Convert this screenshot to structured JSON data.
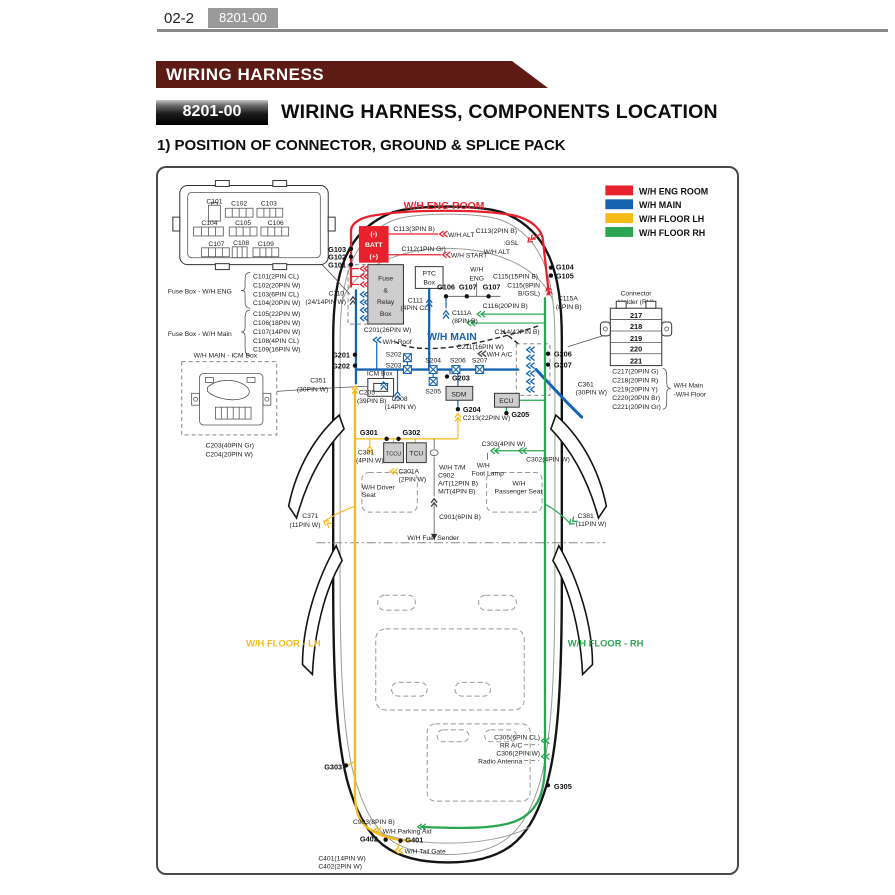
{
  "colors": {
    "eng": "#e8222d",
    "main": "#1663b1",
    "lh": "#f7bb17",
    "rh": "#2aa551",
    "banner": "#5e1a14",
    "badge": "#9a9a9a"
  },
  "header": {
    "page_number": "02-2",
    "code": "8201-00"
  },
  "banner": {
    "title": "WIRING HARNESS"
  },
  "section": {
    "code": "8201-00",
    "title": "WIRING HARNESS, COMPONENTS LOCATION",
    "subtitle": "1) POSITION OF CONNECTOR, GROUND & SPLICE PACK"
  },
  "legend": {
    "items": [
      {
        "label": "W/H ENG ROOM"
      },
      {
        "label": "W/H MAIN"
      },
      {
        "label": "W/H FLOOR LH"
      },
      {
        "label": "W/H FLOOR RH"
      }
    ]
  },
  "diagram": {
    "regions": {
      "eng": "W/H ENG ROOM",
      "main": "W/H MAIN",
      "lh": "W/H FLOOR - LH",
      "rh": "W/H FLOOR - RH"
    },
    "fusebox": {
      "conns": [
        "C101",
        "C102",
        "C103",
        "C104",
        "C105",
        "C106",
        "C107",
        "C108",
        "C109"
      ],
      "eng_label": "Fuse Box - W/H ENG",
      "eng_items": [
        "C101(2PIN CL)",
        "C102(20PIN W)",
        "C103(6PIN CL)",
        "C104(20PIN W)"
      ],
      "main_label": "Fuse Box - W/H Main",
      "main_items": [
        "C105(22PIN W)",
        "C106(18PIN W)",
        "C107(14PIN W)",
        "C108(4PIN CL)",
        "C109(16PIN W)"
      ]
    },
    "icm": {
      "title": "W/H MAIN - ICM Box",
      "c203": "C203(40PIN Gr)",
      "c204": "C204(20PIN W)"
    },
    "holder": {
      "t1": "Connector",
      "t2": "Holder (RH)",
      "rows": [
        "217",
        "218",
        "219",
        "220",
        "221"
      ],
      "items": [
        "C217(20PIN G)",
        "C218(20PIN R)",
        "C219(20PIN Y)",
        "C220(20PIN Br)",
        "C221(20PIN Gr)"
      ],
      "note1": "W/H Main",
      "note2": "-W/H Floor"
    },
    "labels": {
      "bm": "(-)",
      "batt": "BATT",
      "bp": "(+)",
      "c113a": "C113(3PIN B)",
      "whalt1": "W/H ALT",
      "c113b": "C113(2PIN B)",
      "gsl": ":GSL",
      "whalt2": "W/H ALT",
      "c112": "C112(1PIN Gr)",
      "whstart": "W/H START",
      "g103": "G103",
      "g102": "G102",
      "g101": "G101",
      "c110a": "C110",
      "c110b": "(24/14PIN W)",
      "fr1": "Fuse",
      "fr2": "&",
      "fr3": "Relay",
      "fr4": "Box",
      "ptc1": "PTC",
      "ptc2": "Box",
      "wheng1": "W/H",
      "wheng2": "ENG",
      "g106": "G106",
      "g107a": "G107",
      "g107b": "G107",
      "c111a": "C111",
      "c111b": "(4PIN CL)",
      "c111Aa": "C111A",
      "c111Ab": "(8PIN B)",
      "c116": "C116(20PIN B)",
      "c114": "C114(42PIN B)",
      "c115_15": "C115(15PIN B)",
      "c115_8a": "C115(8PIN",
      "c115_8b": "B/GSL)",
      "c115Aa": "C115A",
      "c115Ab": "(8PIN B)",
      "g104": "G104",
      "g105": "G105",
      "g201": "G201",
      "g202": "G202",
      "c351a": "C351",
      "c351b": "(30PIN W)",
      "whroof": "W/H Roof",
      "c201": "C201(26PIN W)",
      "c211": "C211(16PIN W)",
      "whac": "W/H A/C",
      "s202": "S202",
      "s203": "S203",
      "s204": "S204",
      "s205": "S205",
      "s206": "S206",
      "s207": "S207",
      "icmbox": "ICM Box",
      "c205a": "C205",
      "c205b": "(39PIN B)",
      "c208a": "C208",
      "c208b": "(14PIN W)",
      "g203": "G203",
      "sdm": "SDM",
      "g204": "G204",
      "c213": "C213(22PIN W)",
      "ecu": "ECU",
      "g205": "G205",
      "g206": "G206",
      "g207": "G207",
      "c361a": "C361",
      "c361b": "(30PIN W)",
      "g301": "G301",
      "g302": "G302",
      "c301a": "C301",
      "c301b": "(4PIN W)",
      "tccu": "TCCU",
      "tcu": "TCU",
      "c301Aa": "C301A",
      "c301Ab": "(2PIN W)",
      "whdrv1": "W/H Driver",
      "whdrv2": "Seat",
      "whtm": "W/H T/M",
      "c902": "C902",
      "at12": "A/T(12PIN B)",
      "mt4": "M/T(4PIN B)",
      "whfoot1": "W/H",
      "whfoot2": "Foot Lamp",
      "c303": "C303(4PIN W)",
      "c302": "C302(4PIN W)",
      "whpass1": "W/H",
      "whpass2": "Passenger Seat",
      "c901": "C901(6PIN B)",
      "fuel": "W/H Fuel Sender",
      "c371a": "C371",
      "c371b": "(11PIN W)",
      "c381a": "C381",
      "c381b": "(11PIN W)",
      "c305": "C305(6PIN CL)",
      "rrac": "RR A/C",
      "c306": "C306(2PIN W)",
      "radio": "Radio Antenna",
      "g305": "G305",
      "g303": "G303",
      "c903": "C903(8PIN B)",
      "parkaid": "W/H Parking Aid",
      "g402": "G402",
      "g401": "G401",
      "tailgate": "W/H Tail Gate",
      "c401": "C401(14PIN W)",
      "c402": "C402(2PIN W)"
    }
  }
}
